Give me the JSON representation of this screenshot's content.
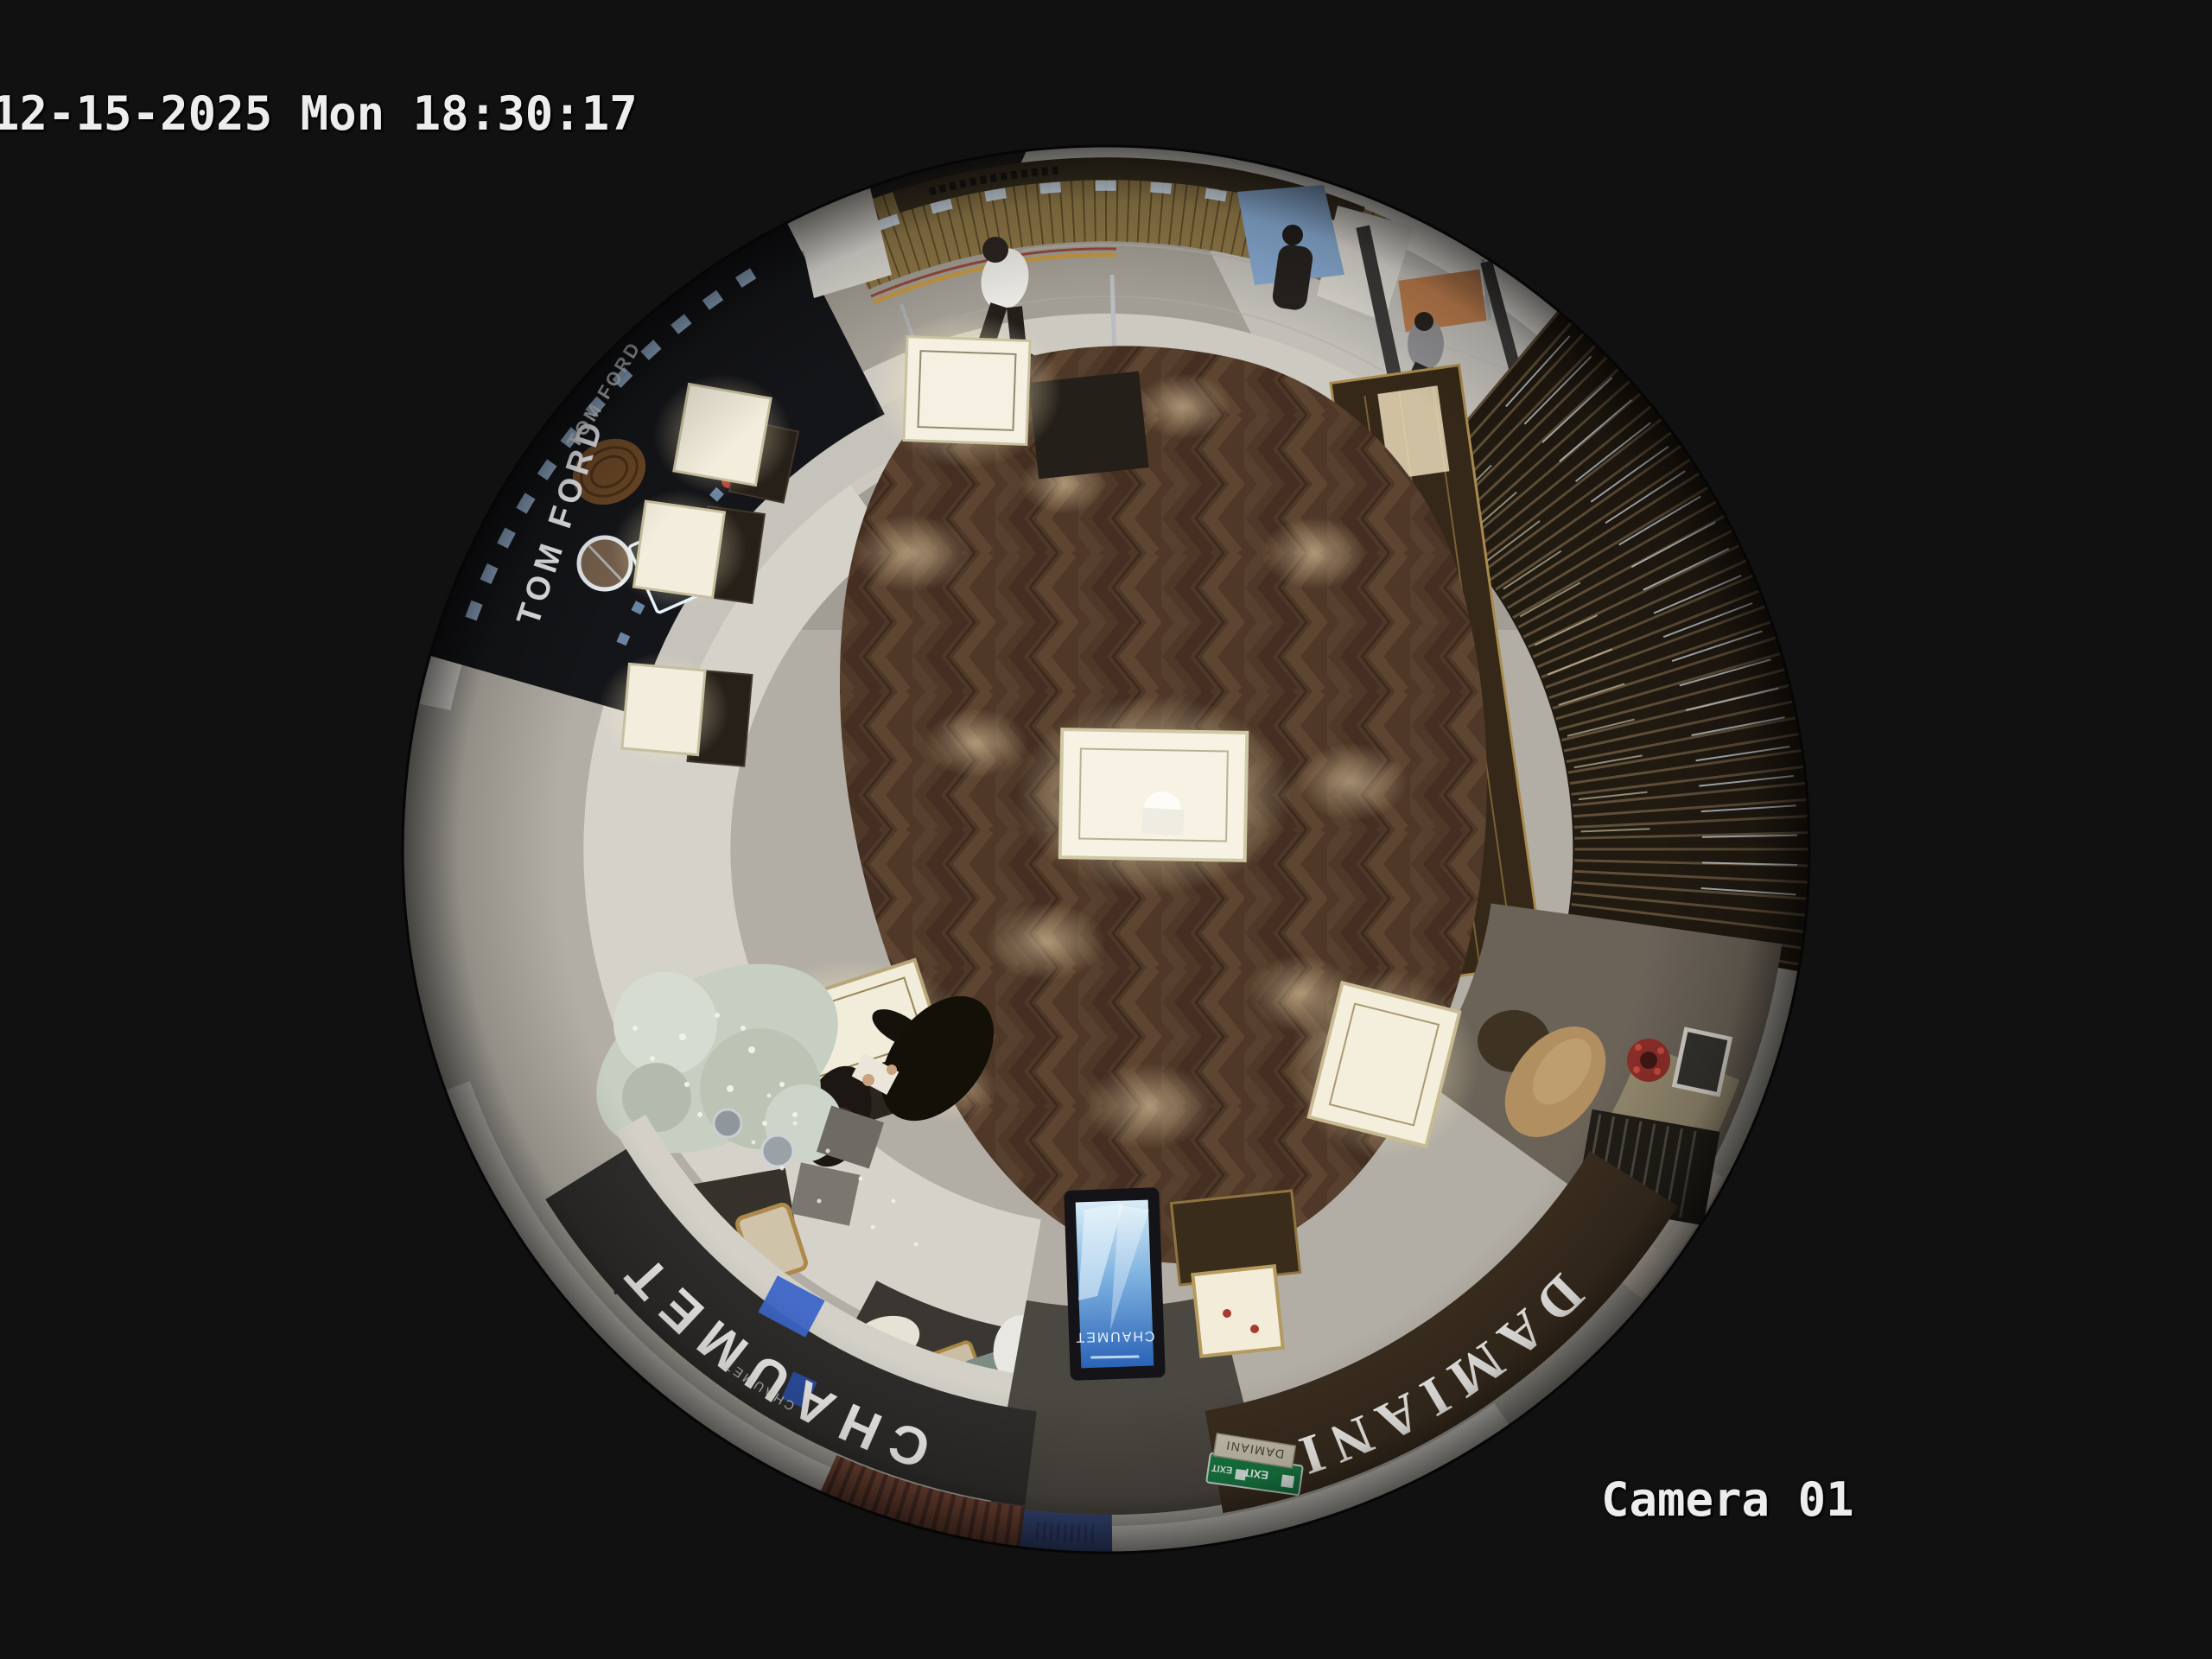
{
  "osd": {
    "timestamp": "12-15-2025 Mon 18:30:17",
    "camera_label": "Camera 01",
    "text_color": "#ededed"
  },
  "signs": {
    "chaumet_fascia": "CHAUMET",
    "chaumet_fascia_sub": "CHAUMET",
    "chaumet_totem": "CHAUMET",
    "damiani_fascia": "DAMIANI",
    "damiani_plaque": "DAMIANI",
    "tom_ford_storefront": "TOM FORD",
    "tf_logo": "TF",
    "exit_sign": "EXIT"
  },
  "palette": {
    "background": "#111111",
    "osd_text": "#ededed",
    "wood_floor": "#4f3827",
    "walkway_tile": "#d5d2ca",
    "corridor_marble": "#a39e95",
    "chaumet_fascia_dark": "#2e2d2b",
    "damiani_fascia_brown": "#3a2d1f",
    "gold_trim": "#a98b4f",
    "kiosk_gold": "#8e7848",
    "totem_screen_blue": "#2a63b8",
    "exit_green": "#177a42",
    "slat_partition": "#211a11",
    "vitrine_light": "#f5f0e2"
  }
}
